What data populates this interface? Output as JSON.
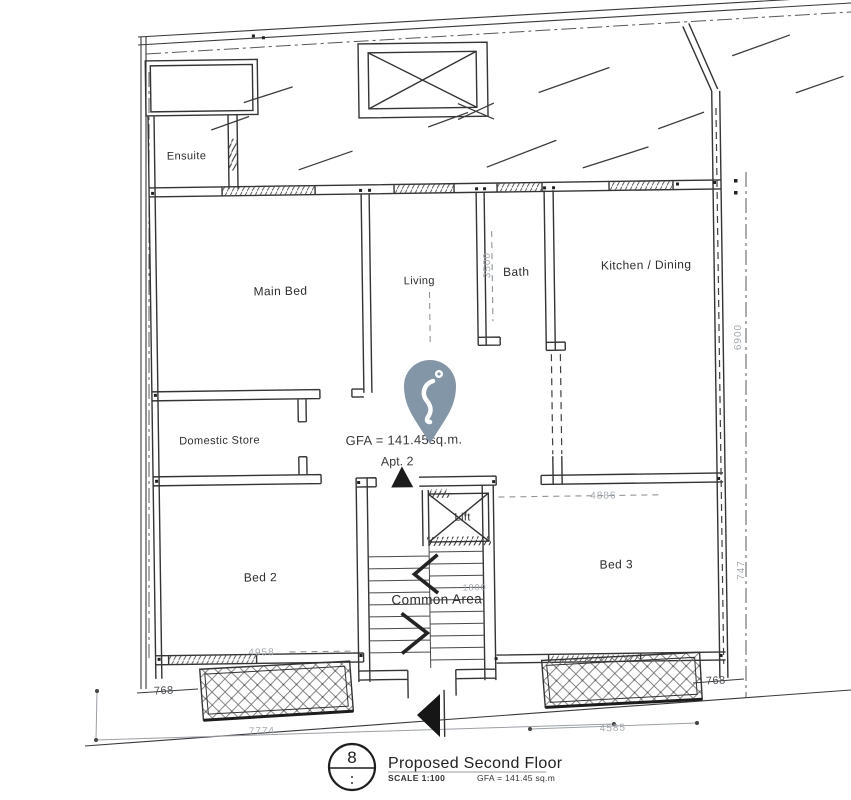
{
  "colors": {
    "ink": "#343434",
    "faint_line": "#9aa0a6",
    "dim_text": "#a4a9af",
    "pin_fill": "#8296a7",
    "paper": "#ffffff"
  },
  "rooms": [
    {
      "label": "Ensuite"
    },
    {
      "label": "Main Bed"
    },
    {
      "label": "Living"
    },
    {
      "label": "Bath"
    },
    {
      "label": "Kitchen / Dining"
    },
    {
      "label": "Domestic Store"
    },
    {
      "label": "Bed 2"
    },
    {
      "label": "Bed 3"
    },
    {
      "label": "Common Area"
    },
    {
      "label": "Lift"
    }
  ],
  "annotations": {
    "gfa": "GFA = 141.45sq.m.",
    "apartment": "Apt. 2"
  },
  "dimensions": {
    "bed2_width": "4958",
    "front_left": "7774",
    "balcony_left_offset": "768",
    "balcony_right_offset": "768",
    "front_right": "4585",
    "bed3_width": "4886",
    "side_depth": "6900",
    "side_lower": "747",
    "bath_depth": "3500",
    "stair_width": "1800"
  },
  "title_block": {
    "drawing_number": "8",
    "title": "Proposed Second Floor",
    "scale": "SCALE 1:100",
    "gfa": "GFA = 141.45 sq.m"
  }
}
